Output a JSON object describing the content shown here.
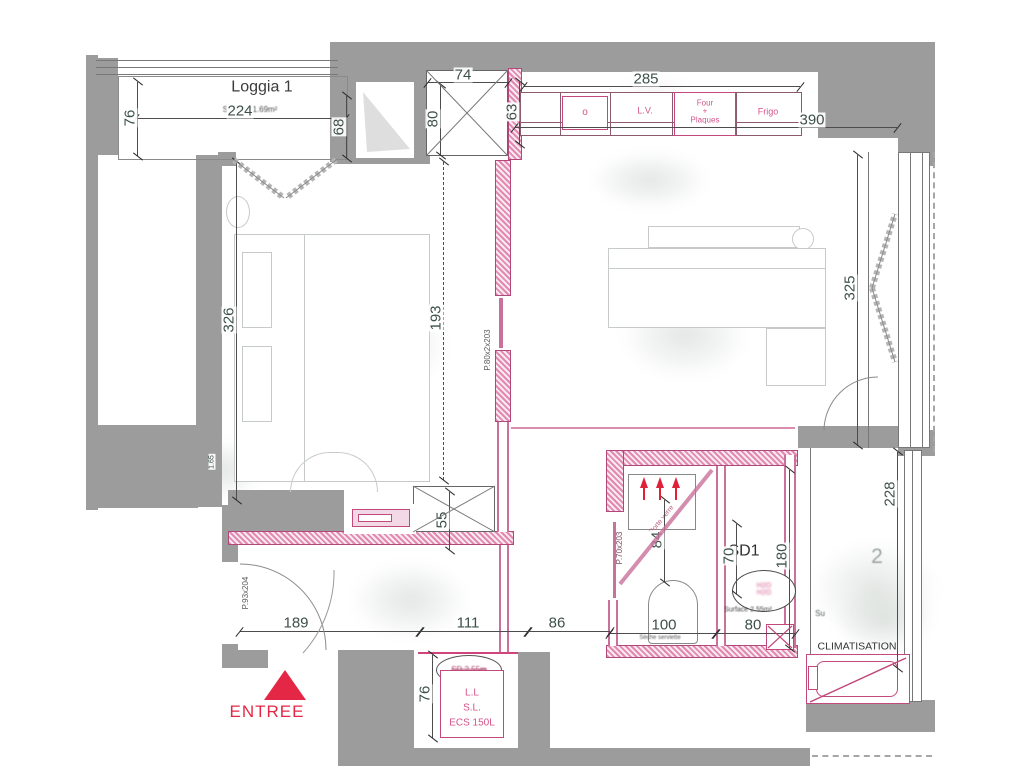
{
  "rooms": {
    "loggia1": {
      "label": "Loggia 1",
      "surface": "Surface:1.69m²"
    },
    "loggia2": {
      "partial_label": "2",
      "surface_hint": "Su",
      "clim": "CLIMATISATION"
    },
    "bathroom": {
      "label": "SD1",
      "bubble_line1": "H2O",
      "bubble_line2": "H2O",
      "surface": "Surface 2.55m²"
    },
    "entry": {
      "label": "ENTREE"
    },
    "utility": {
      "line1": "L.L",
      "line2": "S.L.",
      "line3": "ECS 150L",
      "struck_label": "SD 2.55m"
    }
  },
  "kitchen": {
    "sink": "o",
    "dishwasher": "L.V.",
    "oven1": "Four",
    "oven2": "+",
    "oven3": "Plaques",
    "fridge": "Frigo"
  },
  "doors": {
    "entry_door": "P.93x204",
    "bedroom_door": "P.80x2x203",
    "bathroom_door": "P.70x203",
    "glass_door": "Porte verre",
    "towel_dryer": "Sèche serviette"
  },
  "dims": {
    "loggia_h": "76",
    "loggia_w": "224",
    "loggia_r": "68",
    "shaft_w": "74",
    "shaft_h": "80",
    "kitchen_l": "63",
    "kitchen_w": "285",
    "kitchen_total": "390",
    "bedroom_h": "326",
    "corridor_h": "193",
    "window_h": "325",
    "loggia2_h": "228",
    "closet_d": "55",
    "shower_w": "84",
    "basin_w": "70",
    "bath_h": "180",
    "hall_w": "189",
    "hall_w2": "111",
    "hall_w3": "86",
    "wc_w": "100",
    "basin_w2": "80",
    "ecs_h": "76",
    "niche": "1.65"
  }
}
